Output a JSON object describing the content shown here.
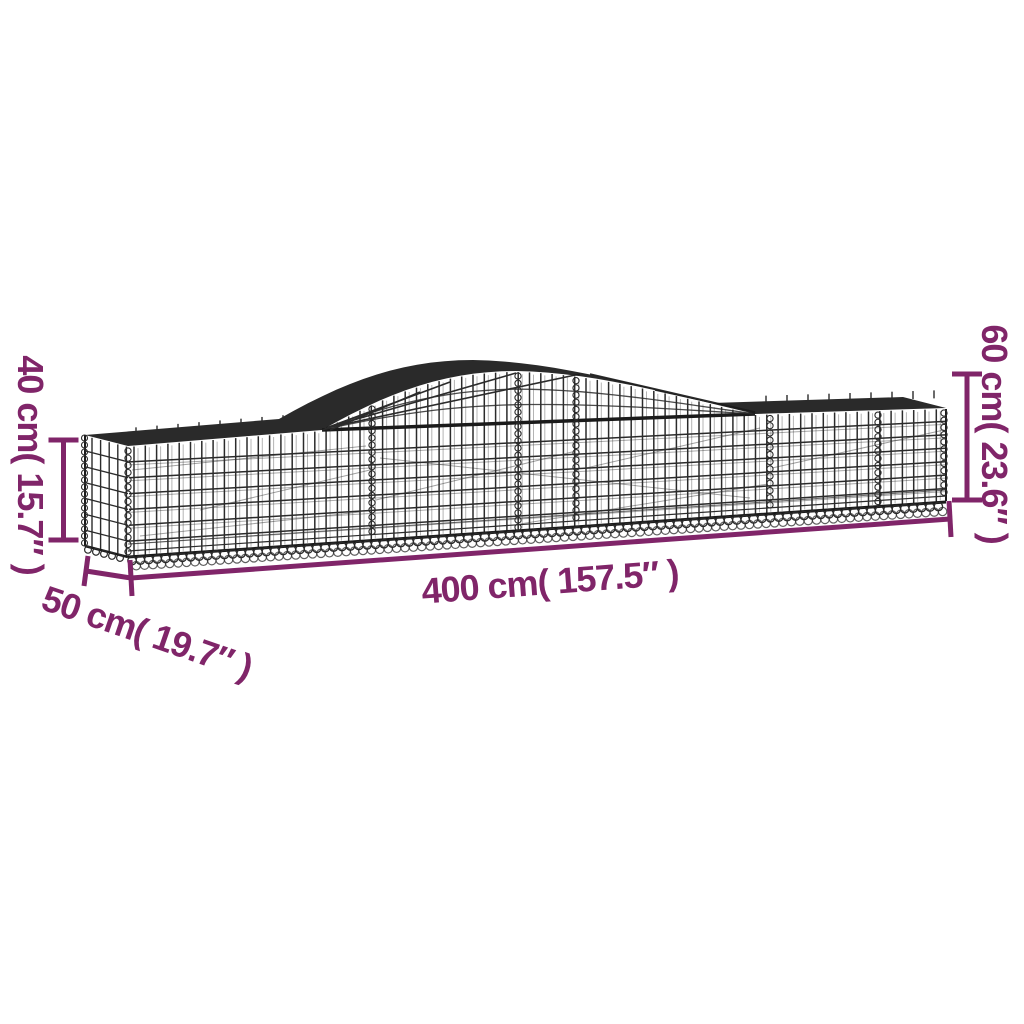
{
  "labels": {
    "height_front": "40 cm( 15.7″ )",
    "height_arch": "60 cm( 23.6″ )",
    "length": "400 cm( 157.5″ )",
    "depth": "50 cm( 19.7″ )"
  },
  "colors": {
    "accent": "#802569",
    "wire": "#2b2b2b",
    "wire_dark": "#1a1a1a",
    "wire_light": "#565656",
    "background": "#ffffff"
  }
}
